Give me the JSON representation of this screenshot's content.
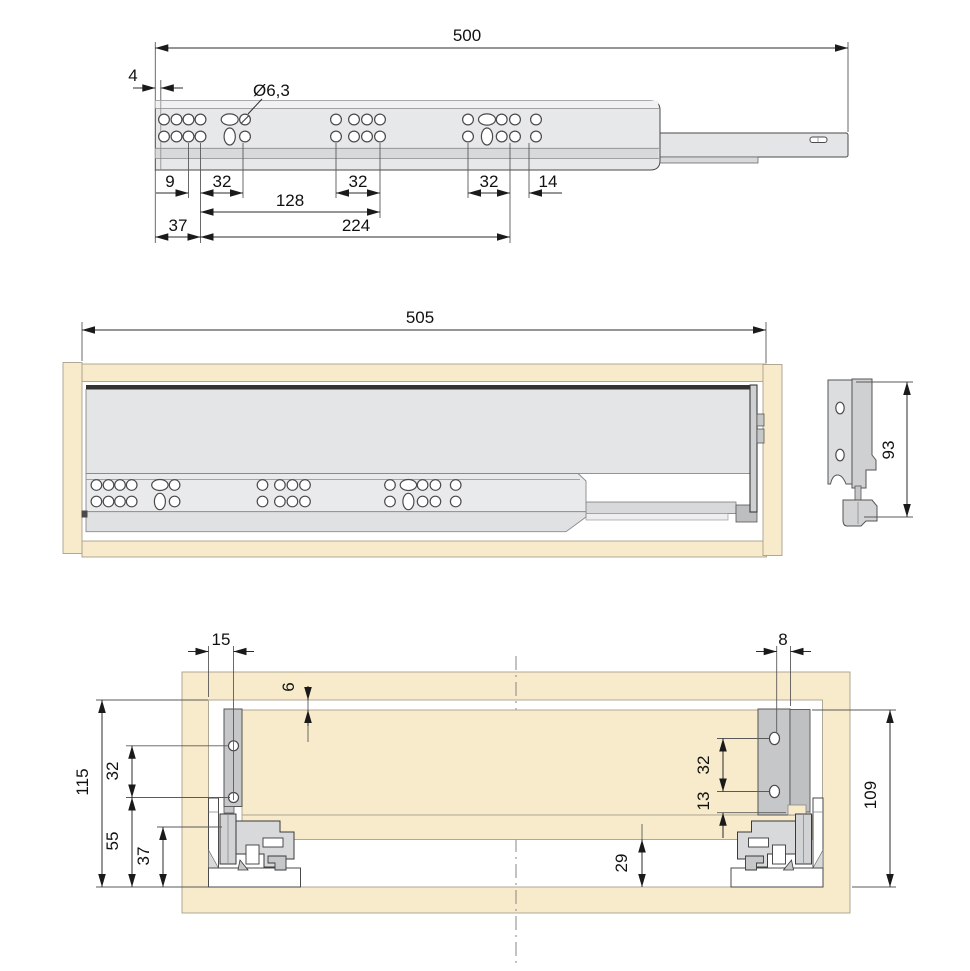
{
  "drawing": {
    "type": "technical-dimension-drawing",
    "views": [
      "slide-rail-top-view",
      "drawer-front-elevation",
      "rear-bracket-side-view",
      "cabinet-cross-section"
    ]
  },
  "dims": {
    "top": {
      "total_length": "500",
      "front_edge_offset": "4",
      "hole_diameter": "Ø6,3",
      "pitch_9": "9",
      "pitch_32_front": "32",
      "span_128": "128",
      "pitch_32_mid": "32",
      "pitch_32_rear": "32",
      "pitch_14": "14",
      "offset_37": "37",
      "span_224": "224"
    },
    "front": {
      "total_length": "505",
      "side_height": "93"
    },
    "section": {
      "front_inset_15": "15",
      "top_gap_6": "6",
      "screw_pitch_left_32": "32",
      "total_height_115": "115",
      "height_55": "55",
      "height_37": "37",
      "rear_inset_8": "8",
      "screw_pitch_right_32": "32",
      "offset_13": "13",
      "back_panel_height_109": "109",
      "bottom_clearance_29": "29"
    }
  },
  "colors": {
    "wood_beige": "#F7EBCB",
    "panel_gray": "#E4E5E7",
    "rail_gray": "#E7E8EA",
    "groove_gray": "#D8D9DB",
    "metal_gray": "#C6C7C9",
    "line_dark": "#2b2b2b"
  }
}
